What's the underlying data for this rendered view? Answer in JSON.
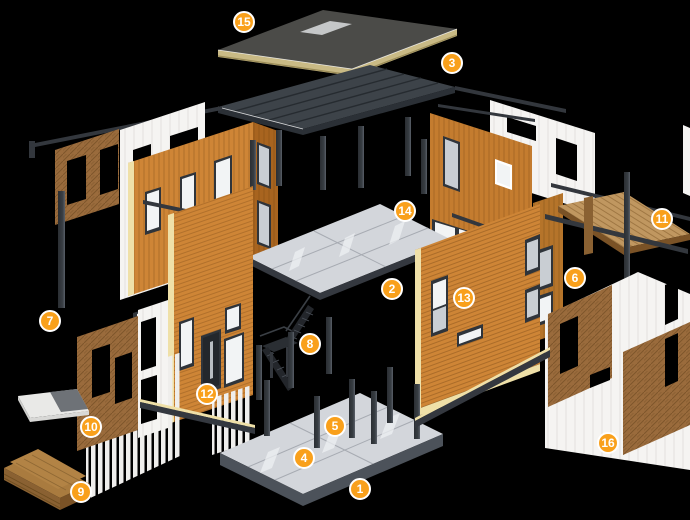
{
  "canvas": {
    "width": 690,
    "height": 520
  },
  "palette": {
    "bg": "#000000",
    "badge-fill": "#F9A01B",
    "badge-ring": "#FFFFFF",
    "badge-text": "#FFFFFF",
    "wood": "#CE8536",
    "wood-dark": "#BC762C",
    "wood-deep": "#A8641F",
    "wood-back": "#C47C2F",
    "wood-6": "#B5742A",
    "wood-edge": "#EFE0A8",
    "cork": "#9A6B3C",
    "panel": "#F5F4F2",
    "slab": "#D3D6DB",
    "slab-sheen": "#EEF0F3",
    "slab-edge": "#34383F",
    "slab-skirt": "#4C525A",
    "steel": "#33373D",
    "steel-light": "#5A6069",
    "frame": "#2F343A",
    "glass": "#F2F4F5",
    "glass-gray": "#C9CED3",
    "roof-top": "#4B4B48",
    "roof-tan": "#C9BA85",
    "roof-tan-dark": "#9C8D58",
    "metal": "#3D4349",
    "metal-dark": "#2B3036",
    "metal-seam": "#262B30",
    "deck": "#C09760",
    "plank": "#A97B3F",
    "plank-2": "#B28345",
    "plank-side": "#8A6132",
    "plank-deep": "#7A5226",
    "stair": "#23262B",
    "stair-2": "#2A2E33"
  },
  "badges": {
    "style": {
      "diameter": 22,
      "font_size": 12
    },
    "items": [
      {
        "label": "1",
        "x": 360,
        "y": 489
      },
      {
        "label": "2",
        "x": 392,
        "y": 289
      },
      {
        "label": "3",
        "x": 452,
        "y": 63
      },
      {
        "label": "4",
        "x": 304,
        "y": 458
      },
      {
        "label": "5",
        "x": 335,
        "y": 426
      },
      {
        "label": "6",
        "x": 575,
        "y": 278
      },
      {
        "label": "7",
        "x": 50,
        "y": 321
      },
      {
        "label": "8",
        "x": 310,
        "y": 344
      },
      {
        "label": "9",
        "x": 81,
        "y": 492
      },
      {
        "label": "10",
        "x": 91,
        "y": 427
      },
      {
        "label": "11",
        "x": 662,
        "y": 219
      },
      {
        "label": "12",
        "x": 207,
        "y": 394
      },
      {
        "label": "13",
        "x": 464,
        "y": 298
      },
      {
        "label": "14",
        "x": 405,
        "y": 211
      },
      {
        "label": "15",
        "x": 244,
        "y": 22
      },
      {
        "label": "16",
        "x": 608,
        "y": 443
      }
    ]
  }
}
